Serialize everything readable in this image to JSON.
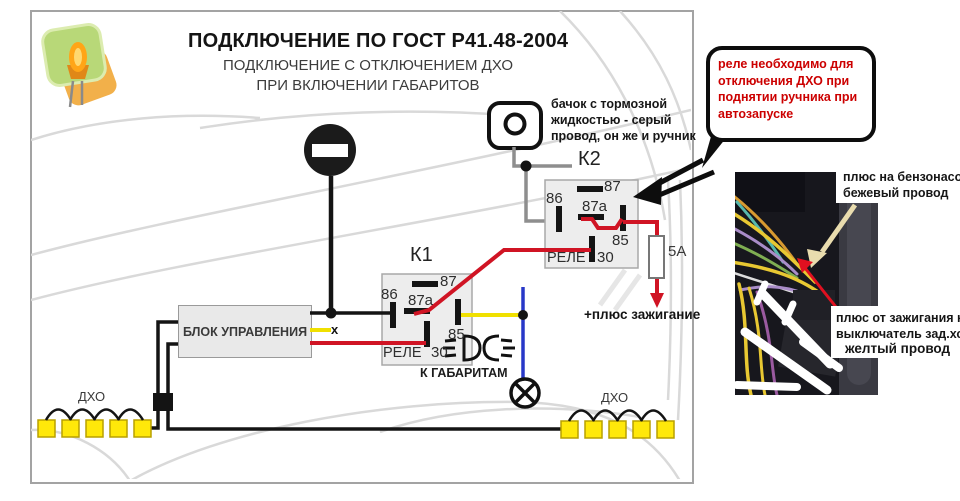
{
  "header": {
    "title": "ПОДКЛЮЧЕНИЕ ПО ГОСТ Р41.48-2004",
    "subtitle_line1": "ПОДКЛЮЧЕНИЕ С ОТКЛЮЧЕНИЕМ ДХО",
    "subtitle_line2": "ПРИ ВКЛЮЧЕНИИ ГАБАРИТОВ"
  },
  "callout": {
    "lines": [
      "реле необходимо для",
      "отключения ДХО при",
      "поднятии ручника при",
      "автозапуске"
    ],
    "text_color": "#cc0000"
  },
  "notes": {
    "reservoir_line1": "бачок с тормозной",
    "reservoir_line2": "жидкостью - серый",
    "reservoir_line3": "провод, он же и ручник",
    "ignition_plus": "+плюс зажигание",
    "to_gabarits": "К ГАБАРИТАМ",
    "x_marker": "x"
  },
  "photo_labels": {
    "fuel_pump_line1": "плюс на бензонасос",
    "fuel_pump_line2": "бежевый провод",
    "ignition_line1": "плюс от зажигания на",
    "ignition_line2": "выключатель зад.хода",
    "ignition_line3": "желтый провод"
  },
  "relay_k1": {
    "label": "К1",
    "name": "РЕЛЕ",
    "pin_87": "87",
    "pin_86": "86",
    "pin_87a": "87а",
    "pin_85": "85",
    "pin_30": "30"
  },
  "relay_k2": {
    "label": "К2",
    "name": "РЕЛЕ",
    "pin_87": "87",
    "pin_86": "86",
    "pin_87a": "87а",
    "pin_85": "85",
    "pin_30": "30"
  },
  "control_unit": {
    "label": "БЛОК УПРАВЛЕНИЯ"
  },
  "fuse": {
    "label": "5А"
  },
  "drl_left": {
    "label": "ДХО"
  },
  "drl_right": {
    "label": "ДХО"
  },
  "colors": {
    "wire_red": "#d01424",
    "wire_yellow": "#f0e000",
    "wire_blue": "#2838c8",
    "wire_gray": "#8e8e8e",
    "wire_black": "#141414",
    "drl_yellow": "#ffe80a",
    "callout_red": "#cc0000"
  }
}
